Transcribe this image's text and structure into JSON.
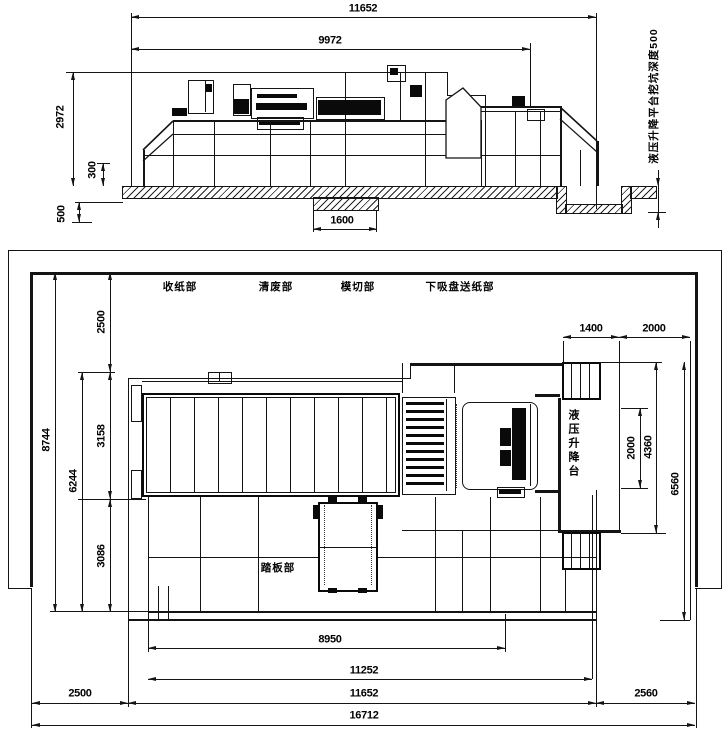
{
  "side_view": {
    "dims": {
      "overall_width": "11652",
      "body_width": "9972",
      "height": "2972",
      "slab_height": "300",
      "foundation_depth": "500",
      "notch_width": "1600"
    },
    "pit_note": "液压升降平台挖坑深度500"
  },
  "plan_view": {
    "sections": [
      {
        "label": "收纸部"
      },
      {
        "label": "清废部"
      },
      {
        "label": "模切部"
      },
      {
        "label": "下吸盘送纸部"
      }
    ],
    "pedal_label": "踏板部",
    "lift_platform_label": "液压升降台",
    "dims": {
      "left_chain": [
        "2500",
        "3158",
        "3086"
      ],
      "left_inner_total": "6244",
      "left_total": "8744",
      "top_right_1": "1400",
      "top_right_2": "2000",
      "right_inner": "2000",
      "right_mid": "4360",
      "right_outer": "6560",
      "bottom_machine": "8950",
      "bottom_feeder": "11252",
      "bottom_left": "2500",
      "bottom_fence": "11652",
      "bottom_right": "2560",
      "bottom_total": "16712"
    }
  }
}
